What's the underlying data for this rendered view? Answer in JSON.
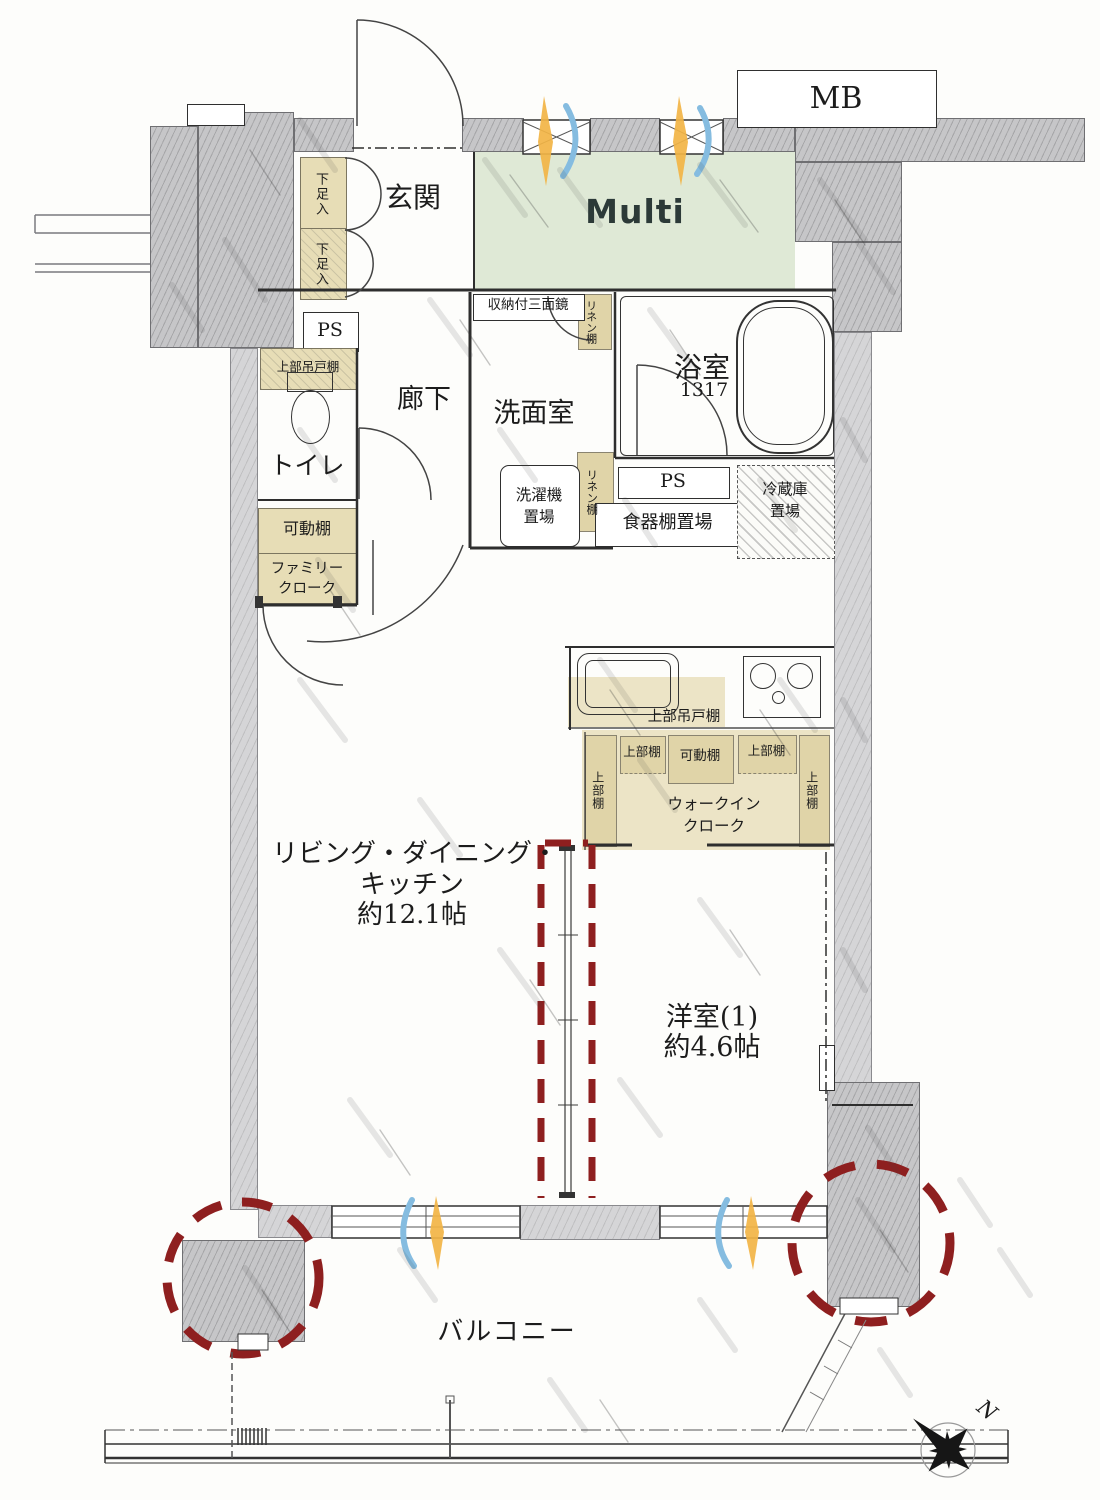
{
  "labels": {
    "mb": "MB",
    "multi": "Multi",
    "genkan": "玄関",
    "shoe_upper": "下足入",
    "shoe_lower": "下足入",
    "ps_left": "PS",
    "hanging_cabinet_left": "上部吊戸棚",
    "toilet": "トイレ",
    "hallway": "廊下",
    "washroom": "洗面室",
    "mirror_cabinet": "収納付三面鏡",
    "linen_top": "リネン棚",
    "linen_mid": "リネン棚",
    "bathroom": "浴室",
    "bath_size": "1317",
    "laundry_l1": "洗濯機",
    "laundry_l2": "置場",
    "ps_center": "PS",
    "dish_shelf": "食器棚置場",
    "fridge_l1": "冷蔵庫",
    "fridge_l2": "置場",
    "movable_shelf_left": "可動棚",
    "family_l1": "ファミリー",
    "family_l2": "クローク",
    "kitchen_hanging": "上部吊戸棚",
    "upper_shelf_left": "上部棚",
    "upper_shelf_a": "上部棚",
    "movable_shelf_wic": "可動棚",
    "upper_shelf_b": "上部棚",
    "upper_shelf_right": "上部棚",
    "wic_l1": "ウォークイン",
    "wic_l2": "クローク",
    "ldk_l1": "リビング・ダイニング・",
    "ldk_l2": "キッチン",
    "ldk_l3": "約12.1帖",
    "western_l1": "洋室(1)",
    "western_l2": "約4.6帖",
    "balcony": "バルコニー",
    "north": "N"
  },
  "colors": {
    "wall_gray": "#c6c6c8",
    "multi_green": "#dfe9d6",
    "shelf_tan": "#e7ddb6",
    "accent_red": "#8e1f1f",
    "vent_orange": "#f2b445",
    "vent_blue": "#85bce0"
  }
}
